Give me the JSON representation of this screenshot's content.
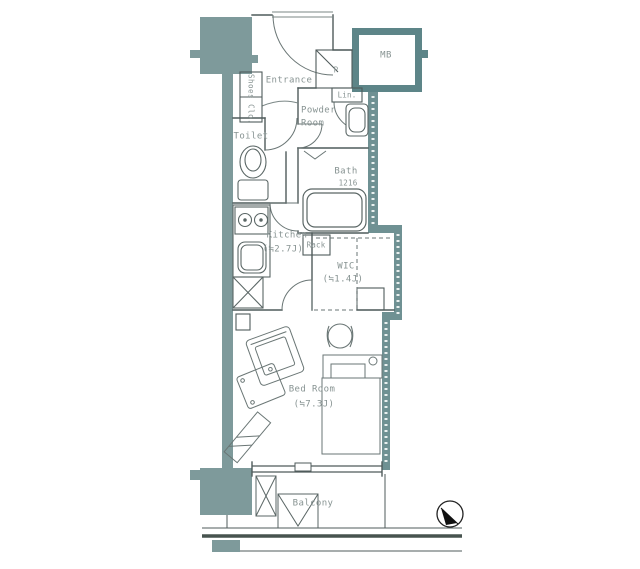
{
  "title": "Apartment floor plan",
  "colors": {
    "wall_column_fill": "#7e9a9b",
    "wall_dark_fill": "#5d8588",
    "wall_mid_fill": "#6f9193",
    "line": "#4f5b5b",
    "label_text": "#879392"
  },
  "rooms": {
    "entrance": {
      "label": "Entrance"
    },
    "shoes_closet": {
      "label": "Shoes Clo."
    },
    "toilet": {
      "label": "Toilet"
    },
    "powder_room": {
      "label_line1": "Powder",
      "label_line2": "Room"
    },
    "pipe_space": {
      "label": "P"
    },
    "linen": {
      "label": "Lin."
    },
    "bath": {
      "label": "Bath",
      "size": "1216"
    },
    "kitchen": {
      "label": "Kitchen",
      "size": "(≒2.7J)"
    },
    "rack": {
      "label": "Rack"
    },
    "wic": {
      "label": "WIC",
      "size": "(≒1.4J)"
    },
    "bedroom": {
      "label": "Bed Room",
      "size": "(≒7.3J)"
    },
    "balcony": {
      "label": "Balcony"
    },
    "meter_box": {
      "label": "MB"
    }
  },
  "icons": {
    "compass_north_icon": "north-arrow",
    "stove_burners_icon": "two-rings",
    "ac_unit_icon": "x-box",
    "evacuation_hatch_icon": "v-box",
    "refrigerator_space_icon": "x-box"
  }
}
